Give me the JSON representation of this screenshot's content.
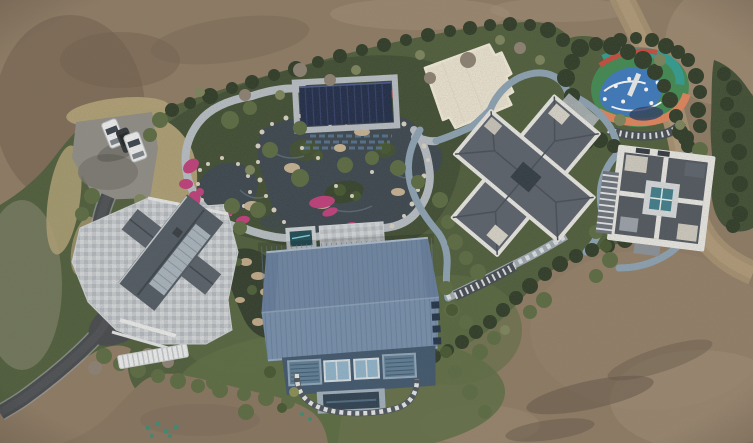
{
  "image": {
    "width": 753,
    "height": 443,
    "kind": "aerial-drone-photo"
  },
  "scene": {
    "description": "Bird's-eye aerial view of a landscaped private estate surrounded by bare brown earth. The grounds contain an ornamental rock pond garden with winding stone paths and pink flower beds, a navy panel-roofed pavilion, a cream flat-roofed building, a multicolour playground, two slate-roofed villas on the east side, a large blue-grey metal gable-roof house in the centre, a west house with stone terrace, a parking area with cars and an asphalt driveway exiting bottom-left.",
    "objects": [
      {
        "name": "bare-earth-surround",
        "label": "Bare brown earth and graded dirt surrounding the estate"
      },
      {
        "name": "estate-grounds",
        "label": "Landscaped grounds with lawns, hedge border and trees"
      },
      {
        "name": "parking-area",
        "label": "Gravel parking pad with two white cars and one dark car"
      },
      {
        "name": "ornamental-pond",
        "label": "Rock-edged ponds with islands, white boulders and ripples"
      },
      {
        "name": "garden-paths",
        "label": "Light stone looping garden paths"
      },
      {
        "name": "flower-beds",
        "label": "Magenta/pink azalea flower beds"
      },
      {
        "name": "navy-pavilion",
        "label": "Dark navy panel-roofed pavilion at the pond"
      },
      {
        "name": "white-flat-roof-building",
        "label": "Cream flat-roofed building"
      },
      {
        "name": "playground",
        "label": "Multicolour rubber-surface playground with slide"
      },
      {
        "name": "pergola-walks",
        "label": "Slatted pergola walkways"
      },
      {
        "name": "villa-cross",
        "label": "Cross-plan villa with slate hip roofs and white parapets"
      },
      {
        "name": "villa-atrium",
        "label": "Square villa with central teal glass atrium"
      },
      {
        "name": "main-barn-house",
        "label": "Large blue-grey standing-seam gable-roof house with window band"
      },
      {
        "name": "stepping-stone-path",
        "label": "Chequered stepping-stone path looping below the main house"
      },
      {
        "name": "west-house",
        "label": "West house with dark gable roof, glass slope and stone terrace"
      },
      {
        "name": "footbridge",
        "label": "White slatted footbridge"
      },
      {
        "name": "driveway",
        "label": "Asphalt driveway curving out of the bottom-left corner"
      },
      {
        "name": "dirt-road",
        "label": "Dirt track along the north-east boundary"
      }
    ]
  },
  "palette": {
    "dirt": "#8e7b64",
    "dirt_dark": "#6e5c49",
    "dirt_light": "#a5927a",
    "dirt_road": "#a59070",
    "lawn": "#4d5d3b",
    "lawn_light": "#5c6d43",
    "garden": "#3e4d32",
    "tree_dark": "#2c3a26",
    "tree_olive": "#5a6b42",
    "dry_grass": "#b3a378",
    "water": "#39454e",
    "path_light": "#b7bfc6",
    "path_blue": "#8ca3b5",
    "asphalt": "#44484c",
    "flower_pink": "#c13d7c",
    "rock_white": "#d9d3c6",
    "pavilion_navy": "#1d2a48",
    "white_roof": "#ece5d3",
    "playground_green": "#3f8a52",
    "playground_blue": "#3a79c0",
    "playground_teal": "#2f9e92",
    "playground_orange": "#e2855c",
    "playground_red": "#c84b3c",
    "villa_roof": "#59616c",
    "villa_trim": "#e9e9e5",
    "barn_roof": "#7590ae",
    "barn_wall": "#3e566e",
    "glass": "#8fb4cc",
    "glass_teal": "#3e7d8c",
    "terrace": "#c6cbd0",
    "car_white": "#f0f2f4",
    "car_dark": "#2e3338",
    "pergola_dark": "#424a52"
  }
}
